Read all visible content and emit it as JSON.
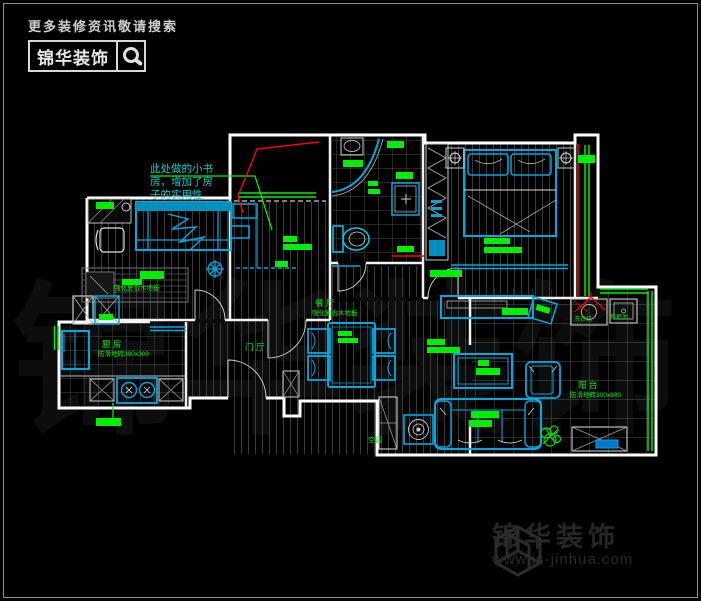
{
  "search_banner": {
    "tagline": "更多装修资讯敬请搜索",
    "brand": "锦华装饰"
  },
  "watermark_text": "锦华装饰",
  "watermark_logo": {
    "brand": "锦华装饰",
    "url": "www.js-jinhua.com"
  },
  "floorplan": {
    "annotation": {
      "line1": "此处做的小书",
      "line2": "房，增加了房",
      "line3": "子的实用性"
    },
    "rooms": {
      "dining": "餐 厅",
      "dining_floor": "强化复合木地板",
      "foyer": "门 厅",
      "kitchen": "厨 房",
      "kitchen_floor": "防滑地砖300x300",
      "balcony": "阳 台",
      "balcony_floor": "防滑地砖300x600",
      "bedroom_floor": "强化复合木地板",
      "ac": "空调",
      "washer": "洗衣机",
      "mop_pool": "拖把池"
    },
    "colors": {
      "wall": "#ffffff",
      "furniture": "#00a8e0",
      "label": "#00ee00",
      "leader": "#ff0000"
    }
  }
}
